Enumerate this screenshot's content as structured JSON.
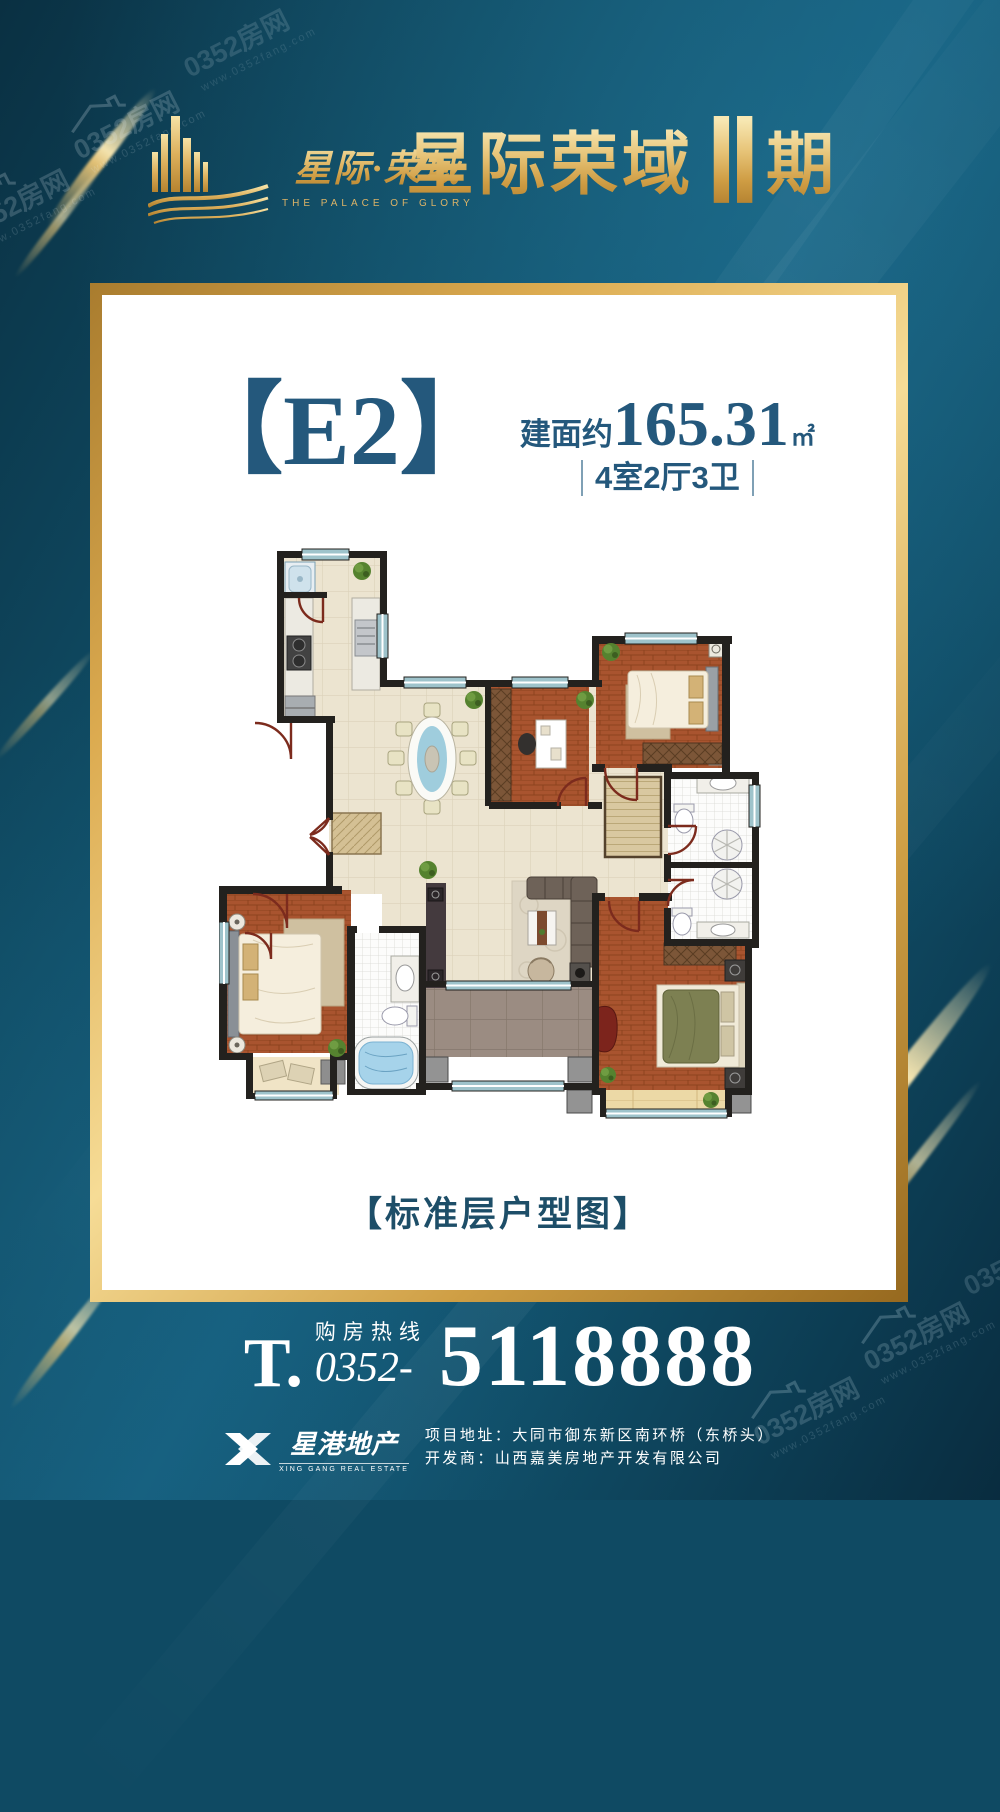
{
  "watermark": {
    "site": "0352房网",
    "url": "www.0352fang.com"
  },
  "header": {
    "logo": {
      "brand": "星际·荣域",
      "tagline": "THE PALACE OF GLORY"
    },
    "title": {
      "name": "星际荣域",
      "phase_numeral": "Ⅱ",
      "phase_unit": "期"
    }
  },
  "card": {
    "unit_label": "【E2】",
    "area": {
      "prefix": "建面约",
      "value": "165.31",
      "unit": "㎡"
    },
    "layout": "4室2厅3卫",
    "caption": "【标准层户型图】"
  },
  "hotline": {
    "t": "T.",
    "label": "购房热线",
    "prefix": "0352-",
    "number": "5118888"
  },
  "footer": {
    "company": "星港地产",
    "company_en": "XING GANG REAL ESTATE",
    "address": "项目地址：大同市御东新区南环桥（东桥头）",
    "developer": "开发商：山西嘉美房地产开发有限公司"
  },
  "colors": {
    "background_teal": "#0f4a63",
    "gold": "#d9a94e",
    "deep_blue_text": "#24587c",
    "white": "#ffffff"
  }
}
